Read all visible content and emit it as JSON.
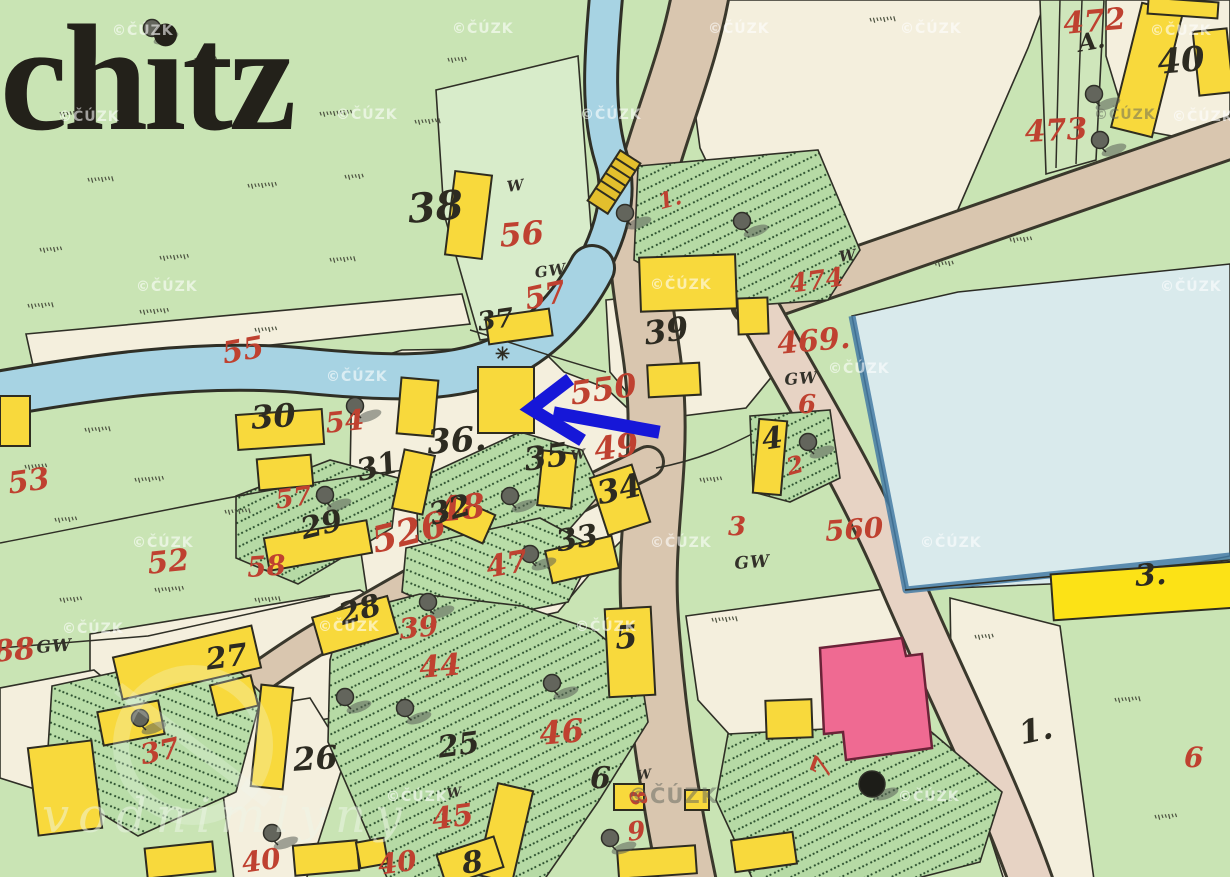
{
  "map_title": "chitz",
  "copyright_watermark": "©ČÚZK",
  "big_watermark": "vodnimlyny",
  "arrow": {
    "description": "blue annotation arrow pointing left at yellow building",
    "color": "#1617d8"
  },
  "colors": {
    "meadow_green": "#c9e4b4",
    "garden_green": "#b6daa5",
    "cream": "#f4efdd",
    "road_beige": "#d9c6af",
    "road_pink": "#e7d3c4",
    "river_blue": "#a7d3e3",
    "pond_blue": "#d9eaec",
    "building_yellow": "#f8d93c",
    "building_pink": "#ef6a92",
    "parcel_red": "#bf4130",
    "ink_black": "#2d2b21"
  },
  "labels": {
    "red_parcel_numbers": [
      {
        "text": "472",
        "x": 1062,
        "y": 10,
        "s": 30,
        "r": -5
      },
      {
        "text": "473",
        "x": 1024,
        "y": 118,
        "s": 30,
        "r": -3
      },
      {
        "text": "474",
        "x": 788,
        "y": 272,
        "s": 26,
        "r": -8
      },
      {
        "text": "469.",
        "x": 776,
        "y": 330,
        "s": 30,
        "r": -5
      },
      {
        "text": "6",
        "x": 798,
        "y": 392,
        "s": 26,
        "r": 0
      },
      {
        "text": "1.",
        "x": 656,
        "y": 192,
        "s": 22,
        "r": -15
      },
      {
        "text": "56",
        "x": 498,
        "y": 220,
        "s": 32,
        "r": -5
      },
      {
        "text": "57",
        "x": 522,
        "y": 286,
        "s": 30,
        "r": -12
      },
      {
        "text": "55",
        "x": 220,
        "y": 340,
        "s": 30,
        "r": -10
      },
      {
        "text": "54",
        "x": 324,
        "y": 410,
        "s": 28,
        "r": -6
      },
      {
        "text": "550",
        "x": 568,
        "y": 378,
        "s": 32,
        "r": -8
      },
      {
        "text": "49",
        "x": 592,
        "y": 434,
        "s": 32,
        "r": -8
      },
      {
        "text": "48",
        "x": 436,
        "y": 494,
        "s": 34,
        "r": -6
      },
      {
        "text": "47",
        "x": 484,
        "y": 554,
        "s": 30,
        "r": -10
      },
      {
        "text": "53",
        "x": 6,
        "y": 470,
        "s": 30,
        "r": -8
      },
      {
        "text": "52",
        "x": 146,
        "y": 550,
        "s": 30,
        "r": -6
      },
      {
        "text": "58",
        "x": 246,
        "y": 554,
        "s": 28,
        "r": -4
      },
      {
        "text": "57",
        "x": 274,
        "y": 488,
        "s": 26,
        "r": -8
      },
      {
        "text": "526",
        "x": 368,
        "y": 524,
        "s": 36,
        "r": -14
      },
      {
        "text": "39",
        "x": 398,
        "y": 616,
        "s": 28,
        "r": -6
      },
      {
        "text": "44",
        "x": 418,
        "y": 654,
        "s": 30,
        "r": -5
      },
      {
        "text": "45",
        "x": 430,
        "y": 806,
        "s": 30,
        "r": -8
      },
      {
        "text": "46",
        "x": 538,
        "y": 718,
        "s": 32,
        "r": -5
      },
      {
        "text": "37",
        "x": 138,
        "y": 742,
        "s": 28,
        "r": -12
      },
      {
        "text": "88",
        "x": -8,
        "y": 638,
        "s": 30,
        "r": -5
      },
      {
        "text": "40",
        "x": 240,
        "y": 850,
        "s": 28,
        "r": -8
      },
      {
        "text": "40",
        "x": 376,
        "y": 852,
        "s": 28,
        "r": -8
      },
      {
        "text": "9",
        "x": 626,
        "y": 820,
        "s": 26,
        "r": -6
      },
      {
        "text": "8",
        "x": 646,
        "y": 788,
        "s": 22,
        "r": 75
      },
      {
        "text": "7",
        "x": 806,
        "y": 772,
        "s": 28,
        "r": -70
      },
      {
        "text": "2",
        "x": 784,
        "y": 456,
        "s": 24,
        "r": -15
      },
      {
        "text": "3",
        "x": 728,
        "y": 514,
        "s": 26,
        "r": 0
      },
      {
        "text": "560",
        "x": 824,
        "y": 518,
        "s": 28,
        "r": -4
      },
      {
        "text": "6",
        "x": 1184,
        "y": 744,
        "s": 28,
        "r": 0
      }
    ],
    "black_house_numbers": [
      {
        "text": "40",
        "x": 1156,
        "y": 46,
        "s": 34,
        "r": -5
      },
      {
        "text": "A.",
        "x": 1076,
        "y": 32,
        "s": 24,
        "r": -10
      },
      {
        "text": "38",
        "x": 406,
        "y": 190,
        "s": 40,
        "r": -5
      },
      {
        "text": "37",
        "x": 476,
        "y": 310,
        "s": 26,
        "r": -8
      },
      {
        "text": "39",
        "x": 642,
        "y": 318,
        "s": 32,
        "r": -8
      },
      {
        "text": "36.",
        "x": 426,
        "y": 426,
        "s": 34,
        "r": -4
      },
      {
        "text": "30",
        "x": 250,
        "y": 402,
        "s": 32,
        "r": -4
      },
      {
        "text": "31",
        "x": 354,
        "y": 458,
        "s": 30,
        "r": -14
      },
      {
        "text": "35",
        "x": 522,
        "y": 444,
        "s": 32,
        "r": -8
      },
      {
        "text": "34",
        "x": 594,
        "y": 478,
        "s": 32,
        "r": -12
      },
      {
        "text": "32",
        "x": 426,
        "y": 502,
        "s": 30,
        "r": -16
      },
      {
        "text": "33",
        "x": 554,
        "y": 528,
        "s": 30,
        "r": -10
      },
      {
        "text": "29",
        "x": 298,
        "y": 516,
        "s": 30,
        "r": -14
      },
      {
        "text": "28",
        "x": 336,
        "y": 602,
        "s": 30,
        "r": -16
      },
      {
        "text": "27",
        "x": 204,
        "y": 646,
        "s": 30,
        "r": -8
      },
      {
        "text": "26",
        "x": 292,
        "y": 744,
        "s": 32,
        "r": -4
      },
      {
        "text": "25",
        "x": 436,
        "y": 734,
        "s": 30,
        "r": -8
      },
      {
        "text": "5",
        "x": 614,
        "y": 622,
        "s": 32,
        "r": -4
      },
      {
        "text": "4",
        "x": 760,
        "y": 426,
        "s": 30,
        "r": -8
      },
      {
        "text": "6",
        "x": 590,
        "y": 764,
        "s": 30,
        "r": 0
      },
      {
        "text": "3.",
        "x": 1134,
        "y": 562,
        "s": 30,
        "r": -4
      },
      {
        "text": "1.",
        "x": 1016,
        "y": 718,
        "s": 32,
        "r": -12
      },
      {
        "text": "8",
        "x": 460,
        "y": 850,
        "s": 30,
        "r": -8
      }
    ],
    "small_annotations": [
      {
        "text": "W",
        "x": 506,
        "y": 180,
        "s": 15,
        "r": -8
      },
      {
        "text": "GW",
        "x": 534,
        "y": 266,
        "s": 15,
        "r": -8
      },
      {
        "text": "W",
        "x": 838,
        "y": 250,
        "s": 15,
        "r": -8
      },
      {
        "text": "GW",
        "x": 784,
        "y": 372,
        "s": 16,
        "r": -4
      },
      {
        "text": "W",
        "x": 570,
        "y": 450,
        "s": 13,
        "r": -8
      },
      {
        "text": "GW",
        "x": 734,
        "y": 556,
        "s": 17,
        "r": -4
      },
      {
        "text": "GW",
        "x": 36,
        "y": 640,
        "s": 17,
        "r": -4
      },
      {
        "text": "W",
        "x": 446,
        "y": 788,
        "s": 13,
        "r": -8
      },
      {
        "text": "W",
        "x": 636,
        "y": 770,
        "s": 13,
        "r": -8
      }
    ],
    "symbols": [
      {
        "text": "✳",
        "x": 495,
        "y": 346,
        "s": 18,
        "r": 0
      }
    ],
    "watermarks": [
      {
        "x": 112,
        "y": 24
      },
      {
        "x": 452,
        "y": 22
      },
      {
        "x": 708,
        "y": 22
      },
      {
        "x": 900,
        "y": 22
      },
      {
        "x": 1150,
        "y": 24
      },
      {
        "x": 58,
        "y": 110
      },
      {
        "x": 336,
        "y": 108
      },
      {
        "x": 580,
        "y": 108
      },
      {
        "x": 1094,
        "y": 108,
        "d": 1
      },
      {
        "x": 1172,
        "y": 110
      },
      {
        "x": 136,
        "y": 280
      },
      {
        "x": 650,
        "y": 278
      },
      {
        "x": 1160,
        "y": 280
      },
      {
        "x": 828,
        "y": 362
      },
      {
        "x": 326,
        "y": 370
      },
      {
        "x": 132,
        "y": 536
      },
      {
        "x": 650,
        "y": 536
      },
      {
        "x": 920,
        "y": 536
      },
      {
        "x": 62,
        "y": 622
      },
      {
        "x": 318,
        "y": 620
      },
      {
        "x": 575,
        "y": 620
      },
      {
        "x": 386,
        "y": 790
      },
      {
        "x": 628,
        "y": 786,
        "d": 1,
        "big": 1
      },
      {
        "x": 898,
        "y": 790
      }
    ]
  }
}
